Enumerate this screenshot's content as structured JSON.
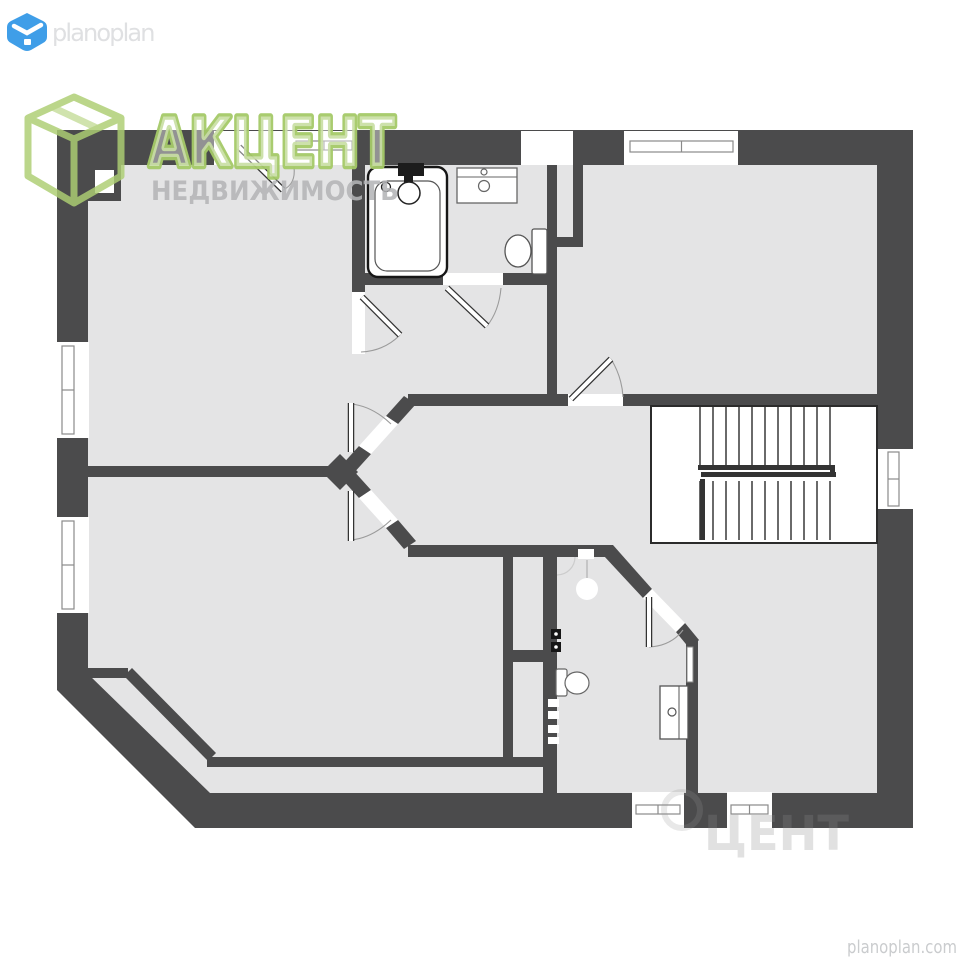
{
  "page": {
    "width": 960,
    "height": 960,
    "bg": "#ffffff"
  },
  "colors": {
    "wall": "#4b4b4c",
    "floor": "#e4e4e5",
    "white": "#ffffff",
    "line": "#2b2b2b",
    "frame": "#8a8a8a",
    "arc": "#9b9b9b",
    "stair_rail": "#333333",
    "fixture_stroke": "#555555"
  },
  "branding": {
    "planoplan_logo_text": "planoplan",
    "planoplan_logo_color": "#dfe0e2",
    "planoplan_icon_color": "#3f9ee8",
    "akcent_title": "АКЦЕНТ",
    "akcent_subtitle": "НЕДВИЖИМОСТЬ",
    "akcent_green": "#a5ca68",
    "akcent_title_fill": "rgba(255,255,255,0.42)",
    "akcent_subtitle_color": "#b3b5b7",
    "footer_site": "planoplan.com",
    "footer_color": "#caccce",
    "ghost_text": "ЦЕНТ",
    "ghost_color": "rgba(138,138,140,0.26)"
  },
  "floorplan": {
    "exterior_outer": "M57,130 L913,130 L913,828 L195,828 L57,690 Z",
    "floor_inner": "M88,165 L877,165 L877,793 L210,793 L88,674 Z",
    "wall_rects": [
      {
        "x": 352,
        "y": 165,
        "w": 13,
        "h": 127,
        "name": "bath-wall-left"
      },
      {
        "x": 365,
        "y": 273,
        "w": 78,
        "h": 12,
        "name": "bath-wall-bottom-left"
      },
      {
        "x": 503,
        "y": 273,
        "w": 45,
        "h": 12,
        "name": "bath-wall-bottom-right"
      },
      {
        "x": 547,
        "y": 165,
        "w": 10,
        "h": 82,
        "name": "duct-wall-left"
      },
      {
        "x": 573,
        "y": 165,
        "w": 10,
        "h": 82,
        "name": "duct-wall-right"
      },
      {
        "x": 547,
        "y": 237,
        "w": 36,
        "h": 10,
        "name": "duct-wall-bottom"
      },
      {
        "x": 547,
        "y": 247,
        "w": 10,
        "h": 150,
        "name": "bath-wall-right"
      },
      {
        "x": 408,
        "y": 394,
        "w": 160,
        "h": 12,
        "name": "hall-wall-top-left"
      },
      {
        "x": 623,
        "y": 394,
        "w": 254,
        "h": 12,
        "name": "hall-wall-top-right"
      },
      {
        "x": 408,
        "y": 545,
        "w": 205,
        "h": 12,
        "name": "hall-wall-bottom"
      },
      {
        "x": 503,
        "y": 557,
        "w": 10,
        "h": 205,
        "name": "closet-wall-left"
      },
      {
        "x": 543,
        "y": 557,
        "w": 14,
        "h": 240,
        "name": "wc-wall-left"
      },
      {
        "x": 503,
        "y": 650,
        "w": 54,
        "h": 12,
        "name": "shaft-wall-bottom"
      },
      {
        "x": 207,
        "y": 757,
        "w": 350,
        "h": 10,
        "name": "strip-wall-top"
      },
      {
        "x": 686,
        "y": 640,
        "w": 12,
        "h": 153,
        "name": "wc-wall-right"
      },
      {
        "x": 88,
        "y": 466,
        "w": 254,
        "h": 11,
        "name": "rooms-divider-wall"
      },
      {
        "x": 88,
        "y": 163,
        "w": 33,
        "h": 38,
        "name": "chimney"
      },
      {
        "x": 88,
        "y": 668,
        "w": 40,
        "h": 10,
        "name": "diag-wall-stub"
      }
    ],
    "wall_polys": [
      {
        "points": "340,467 359,446 371,454 352,475",
        "name": "chevron-upper-a"
      },
      {
        "points": "386,416 404,396 416,404 398,424",
        "name": "chevron-upper-b"
      },
      {
        "points": "340,477 352,469 371,490 359,498",
        "name": "chevron-lower-a"
      },
      {
        "points": "386,528 398,520 416,541 404,549",
        "name": "chevron-lower-b"
      },
      {
        "points": "340,454 358,472 340,490 322,472",
        "name": "chevron-tip"
      },
      {
        "points": "604,556 613,545 652,589 643,598",
        "name": "wc-diag-wall"
      },
      {
        "points": "676,632 685,623 699,640 690,649",
        "name": "wc-diag-wall-short"
      },
      {
        "points": "124,676 132,668 216,753 208,761",
        "name": "roomb-diag-wall"
      }
    ],
    "opening_rects": [
      {
        "x": 214,
        "y": 131,
        "w": 78,
        "h": 34,
        "name": "entry-door-opening"
      },
      {
        "x": 292,
        "y": 131,
        "w": 62,
        "h": 34,
        "name": "window-top-left-opening"
      },
      {
        "x": 521,
        "y": 131,
        "w": 52,
        "h": 34,
        "name": "vent-opening"
      },
      {
        "x": 624,
        "y": 131,
        "w": 114,
        "h": 34,
        "name": "window-top-right-opening"
      },
      {
        "x": 56,
        "y": 342,
        "w": 33,
        "h": 96,
        "name": "window-left-upper-opening"
      },
      {
        "x": 56,
        "y": 517,
        "w": 33,
        "h": 96,
        "name": "window-left-lower-opening"
      },
      {
        "x": 876,
        "y": 449,
        "w": 38,
        "h": 60,
        "name": "window-right-opening"
      },
      {
        "x": 632,
        "y": 792,
        "w": 52,
        "h": 36,
        "name": "window-bottom-left-opening"
      },
      {
        "x": 727,
        "y": 792,
        "w": 45,
        "h": 36,
        "name": "window-bottom-right-opening"
      },
      {
        "x": 352,
        "y": 292,
        "w": 13,
        "h": 62,
        "name": "bath-door-a-opening"
      },
      {
        "x": 443,
        "y": 273,
        "w": 60,
        "h": 12,
        "name": "bath-door-b-opening"
      },
      {
        "x": 568,
        "y": 394,
        "w": 55,
        "h": 12,
        "name": "roomc-door-opening"
      }
    ],
    "opening_polys": [
      {
        "points": "359,446 386,416 398,424 371,454",
        "name": "rooma-door-opening"
      },
      {
        "points": "359,498 371,490 398,520 386,528",
        "name": "roomb-door-opening"
      },
      {
        "points": "643,598 652,589 685,623 676,632",
        "name": "wc-door-opening"
      }
    ],
    "window_frames": [
      {
        "x": 296,
        "y": 141,
        "w": 56,
        "h": 9,
        "o": "h"
      },
      {
        "x": 630,
        "y": 141,
        "w": 103,
        "h": 11,
        "o": "h"
      },
      {
        "x": 62,
        "y": 346,
        "w": 12,
        "h": 88,
        "o": "v"
      },
      {
        "x": 62,
        "y": 521,
        "w": 12,
        "h": 88,
        "o": "v"
      },
      {
        "x": 888,
        "y": 452,
        "w": 11,
        "h": 54,
        "o": "v"
      },
      {
        "x": 636,
        "y": 805,
        "w": 44,
        "h": 9,
        "o": "h"
      },
      {
        "x": 731,
        "y": 805,
        "w": 37,
        "h": 9,
        "o": "h"
      }
    ],
    "door_leaves": [
      {
        "x1": 239,
        "y1": 147,
        "x2": 283,
        "y2": 190,
        "name": "entry-door-leaf"
      },
      {
        "x1": 362,
        "y1": 297,
        "x2": 400,
        "y2": 335,
        "name": "bath-door-a-leaf"
      },
      {
        "x1": 447,
        "y1": 288,
        "x2": 487,
        "y2": 326,
        "name": "bath-door-b-leaf"
      },
      {
        "x1": 571,
        "y1": 399,
        "x2": 611,
        "y2": 359,
        "name": "roomc-door-leaf"
      },
      {
        "x1": 351,
        "y1": 403,
        "x2": 351,
        "y2": 452,
        "name": "rooma-door-leaf"
      },
      {
        "x1": 351,
        "y1": 491,
        "x2": 351,
        "y2": 541,
        "name": "roomb-door-leaf"
      },
      {
        "x1": 649,
        "y1": 597,
        "x2": 649,
        "y2": 647,
        "name": "wc-door-leaf"
      }
    ],
    "door_arcs": [
      {
        "d": "M283,190 Q296,184 294,167"
      },
      {
        "d": "M400,335 Q384,351 361,352"
      },
      {
        "d": "M487,326 Q499,311 501,288"
      },
      {
        "d": "M611,359 Q622,377 623,397"
      },
      {
        "d": "M351,404 Q372,406 391,424"
      },
      {
        "d": "M351,540 Q372,538 391,520"
      },
      {
        "d": "M649,647 Q671,646 683,630"
      }
    ],
    "stairs": {
      "x": 651,
      "y": 406,
      "w": 226,
      "h": 137,
      "tread_x0": 700,
      "tread_dx": 13,
      "tread_n": 11,
      "upper_y1": 407,
      "upper_y2": 466,
      "lower_y1": 481,
      "lower_y2": 540,
      "rails": [
        {
          "x": 698,
          "y": 465,
          "w": 136,
          "h": 5
        },
        {
          "x": 701,
          "y": 472,
          "w": 135,
          "h": 5
        },
        {
          "x": 830,
          "y": 465,
          "w": 5,
          "h": 12
        },
        {
          "x": 700,
          "y": 479,
          "w": 5,
          "h": 61
        }
      ]
    },
    "fixtures": {
      "rects": [
        {
          "x": 368,
          "y": 167,
          "w": 79,
          "h": 110,
          "rx": 10,
          "fill": "#ffffff",
          "stroke": "#161616",
          "sw": 2.4,
          "name": "bathtub-outer"
        },
        {
          "x": 375,
          "y": 181,
          "w": 65,
          "h": 90,
          "rx": 12,
          "fill": "none",
          "stroke": "#555555",
          "sw": 1.2,
          "name": "bathtub-inner"
        },
        {
          "x": 398,
          "y": 163,
          "w": 26,
          "h": 13,
          "fill": "#1c1c1c",
          "name": "bathtub-faucet"
        },
        {
          "x": 404,
          "y": 176,
          "w": 9,
          "h": 12,
          "fill": "#1c1c1c",
          "name": "bathtub-faucet-stem"
        },
        {
          "x": 457,
          "y": 168,
          "w": 60,
          "h": 35,
          "fill": "#ffffff",
          "stroke": "#666666",
          "sw": 1.3,
          "name": "bath-sink-vanity"
        },
        {
          "x": 532,
          "y": 229,
          "w": 15,
          "h": 45,
          "rx": 2,
          "fill": "#ffffff",
          "stroke": "#555555",
          "sw": 1.3,
          "name": "bath-toilet-tank"
        },
        {
          "x": 556,
          "y": 669,
          "w": 11,
          "h": 27,
          "rx": 2,
          "fill": "#ffffff",
          "stroke": "#666666",
          "sw": 1.2,
          "name": "wc-toilet-tank"
        },
        {
          "x": 551,
          "y": 629,
          "w": 10,
          "h": 10,
          "fill": "#161616",
          "name": "wc-valve-a"
        },
        {
          "x": 551,
          "y": 642,
          "w": 10,
          "h": 10,
          "fill": "#161616",
          "name": "wc-valve-b"
        },
        {
          "x": 548,
          "y": 699,
          "w": 11,
          "h": 8,
          "fill": "#ffffff",
          "name": "wc-radiator-a"
        },
        {
          "x": 548,
          "y": 711,
          "w": 11,
          "h": 8,
          "fill": "#ffffff",
          "name": "wc-radiator-b"
        },
        {
          "x": 548,
          "y": 725,
          "w": 11,
          "h": 8,
          "fill": "#ffffff",
          "name": "wc-radiator-c"
        },
        {
          "x": 548,
          "y": 737,
          "w": 11,
          "h": 7,
          "fill": "#ffffff",
          "name": "wc-radiator-d"
        },
        {
          "x": 660,
          "y": 686,
          "w": 28,
          "h": 53,
          "fill": "#ffffff",
          "stroke": "#555555",
          "sw": 1.3,
          "name": "wc-sink-cabinet"
        },
        {
          "x": 687,
          "y": 647,
          "w": 6,
          "h": 35,
          "fill": "#ffffff",
          "stroke": "#888888",
          "sw": 1,
          "name": "wc-wall-item"
        },
        {
          "x": 95,
          "y": 170,
          "w": 19,
          "h": 23,
          "fill": "#ffffff",
          "name": "chimney-flue"
        },
        {
          "x": 578,
          "y": 549,
          "w": 16,
          "h": 10,
          "fill": "#ffffff",
          "name": "wc-fan"
        }
      ],
      "circles": [
        {
          "cx": 409,
          "cy": 193,
          "r": 11,
          "fill": "#ffffff",
          "stroke": "#222222",
          "sw": 1.5,
          "name": "bathtub-drain"
        },
        {
          "cx": 386,
          "cy": 187,
          "r": 4.5,
          "fill": "#ffffff",
          "stroke": "#222222",
          "sw": 1.3,
          "name": "bathtub-tap"
        },
        {
          "cx": 484,
          "cy": 172,
          "r": 3,
          "fill": "#ffffff",
          "stroke": "#666666",
          "sw": 1.2,
          "name": "sink-tap-small"
        },
        {
          "cx": 484,
          "cy": 186,
          "r": 5.5,
          "fill": "#ffffff",
          "stroke": "#666666",
          "sw": 1.2,
          "name": "sink-tap-large"
        },
        {
          "cx": 672,
          "cy": 712,
          "r": 4,
          "fill": "none",
          "stroke": "#555555",
          "sw": 1.2,
          "name": "wc-sink-tap"
        },
        {
          "cx": 587,
          "cy": 589,
          "r": 11,
          "fill": "#ffffff",
          "name": "wc-lamp"
        },
        {
          "cx": 556,
          "cy": 634,
          "r": 1.8,
          "fill": "#ffffff",
          "name": "wc-valve-dot-a"
        },
        {
          "cx": 556,
          "cy": 647,
          "r": 1.8,
          "fill": "#ffffff",
          "name": "wc-valve-dot-b"
        }
      ],
      "ellipses": [
        {
          "cx": 518,
          "cy": 251,
          "rx": 13,
          "ry": 16,
          "fill": "#ffffff",
          "stroke": "#555555",
          "sw": 1.3,
          "name": "bath-toilet-bowl"
        },
        {
          "cx": 577,
          "cy": 683,
          "rx": 12,
          "ry": 11,
          "fill": "#ffffff",
          "stroke": "#666666",
          "sw": 1.2,
          "name": "wc-toilet-bowl"
        }
      ],
      "lines": [
        {
          "x1": 457,
          "y1": 177,
          "x2": 517,
          "y2": 177,
          "stroke": "#666666",
          "sw": 1,
          "name": "sink-edge-line"
        },
        {
          "x1": 679,
          "y1": 686,
          "x2": 679,
          "y2": 739,
          "stroke": "#555555",
          "sw": 1,
          "name": "cabinet-divider"
        },
        {
          "x1": 587,
          "y1": 578,
          "x2": 587,
          "y2": 560,
          "stroke": "#bbbbbb",
          "sw": 1.5,
          "name": "wc-lamp-stem"
        }
      ],
      "paths": [
        {
          "d": "M575,557 A18,18 0 0 1 557,575",
          "stroke": "#cccccc",
          "sw": 1.2,
          "fill": "none",
          "name": "wc-corner-arc"
        }
      ]
    }
  }
}
